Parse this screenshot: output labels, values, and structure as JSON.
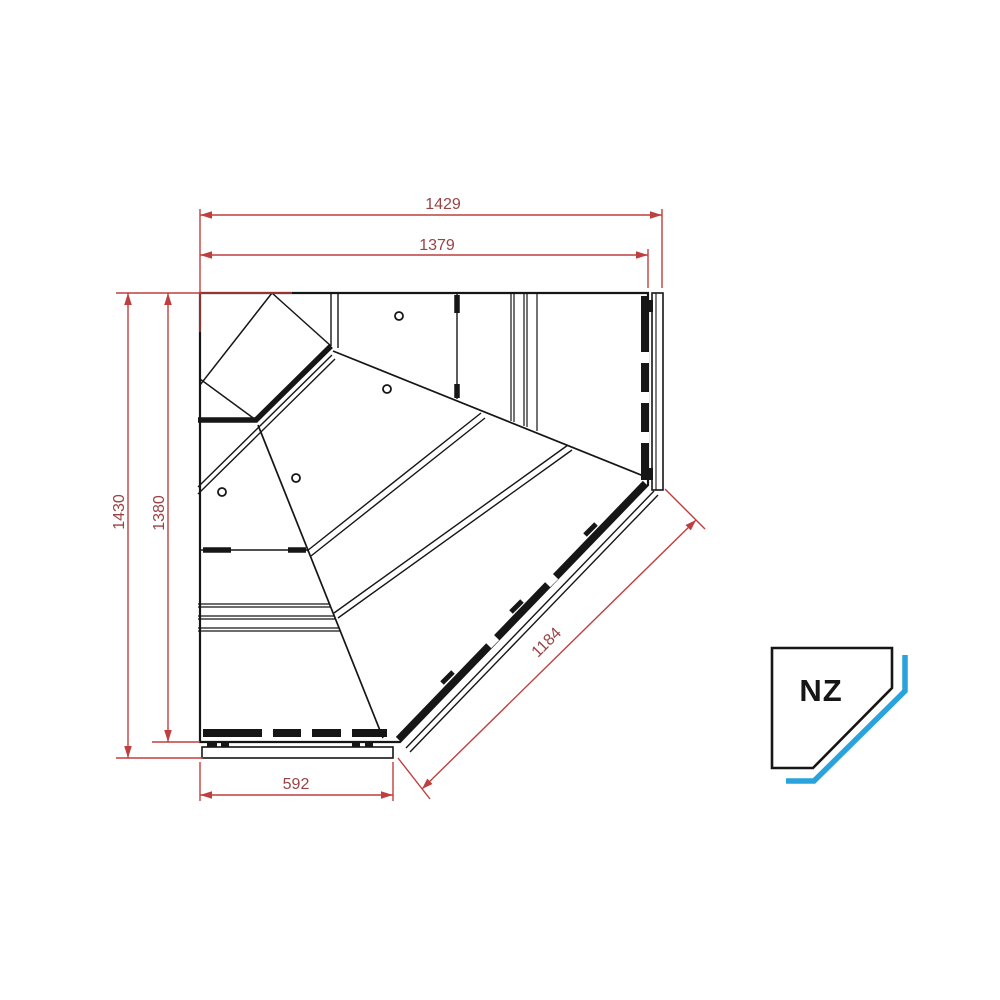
{
  "drawing": {
    "type": "technical-plan-corner-display-counter",
    "dimensions": [
      {
        "id": "outer-width",
        "value": "1429"
      },
      {
        "id": "inner-width",
        "value": "1379"
      },
      {
        "id": "outer-height",
        "value": "1430"
      },
      {
        "id": "inner-height",
        "value": "1380"
      },
      {
        "id": "front-diagonal",
        "value": "1184"
      },
      {
        "id": "end-width",
        "value": "592"
      }
    ],
    "colors": {
      "line": "#161616",
      "dimension_line": "#bf3f3f",
      "dimension_text": "#9a4345",
      "logo_accent": "#2aa3dc",
      "background": "#ffffff"
    }
  },
  "logo": {
    "label": "NZ"
  }
}
